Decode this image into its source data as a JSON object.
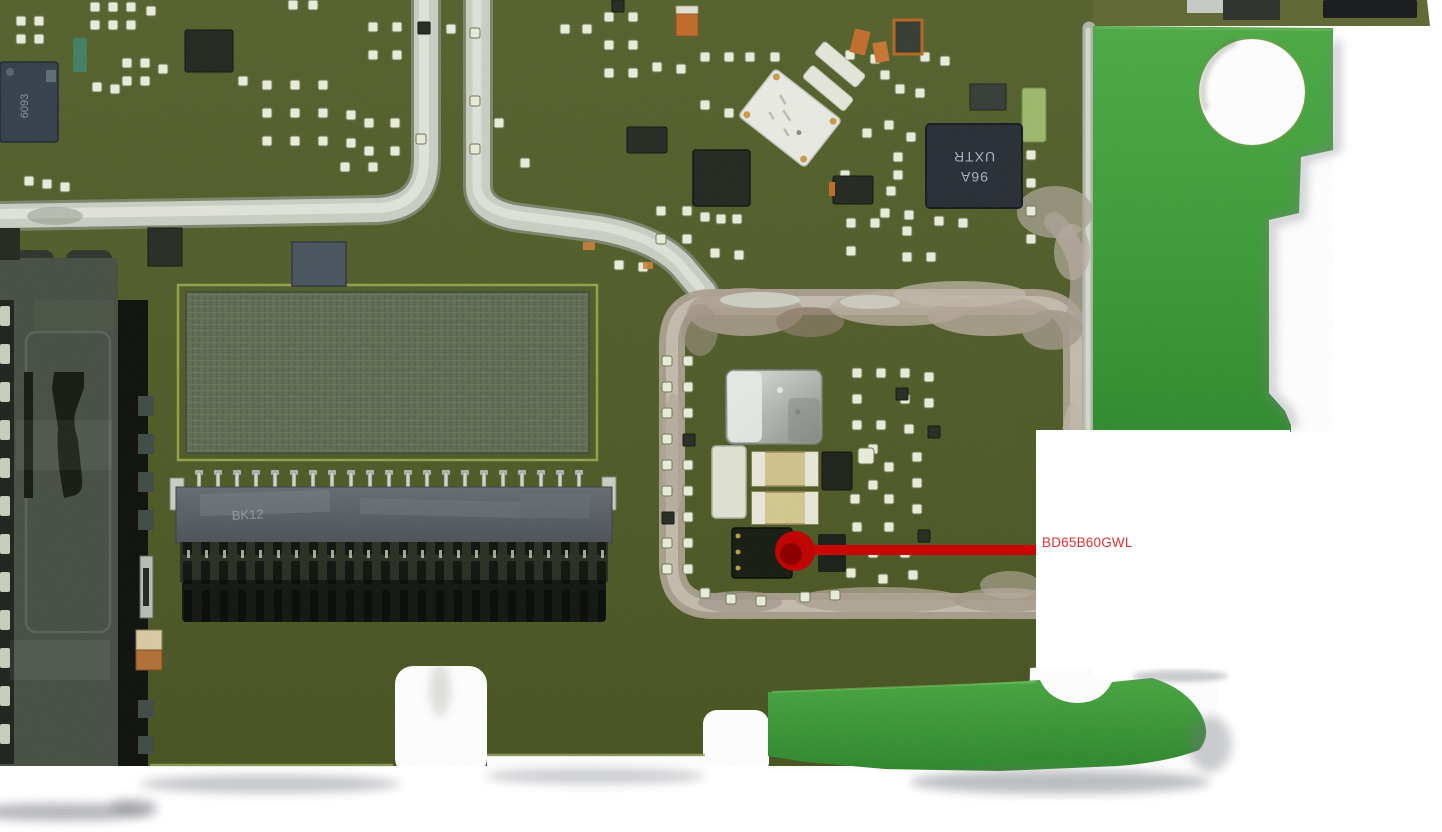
{
  "callout": {
    "label": "BD65B60GWL",
    "text_color": "#e03030",
    "line_color": "#cb0505",
    "dot_color": "#c00505",
    "dot_inner_color": "#8c0202",
    "box_color": "#ffffff"
  },
  "component_markings": {
    "top_left_ic": "6093",
    "fpc_connector": "BK12",
    "rf_ic_line1": "96A",
    "rf_ic_line2": "UXTR"
  },
  "board_colors": {
    "solder_mask_olive": "#4e5a26",
    "solder_mask_bright_green": "#3f9d3c",
    "shield_trace_silver": "#ccd1c6",
    "shield_ring_smudge": "#a89d8e",
    "pad_white": "#e9ecd9",
    "ic_black": "#14180d",
    "connector_slate": "#575d62",
    "background": "#ffffff"
  }
}
